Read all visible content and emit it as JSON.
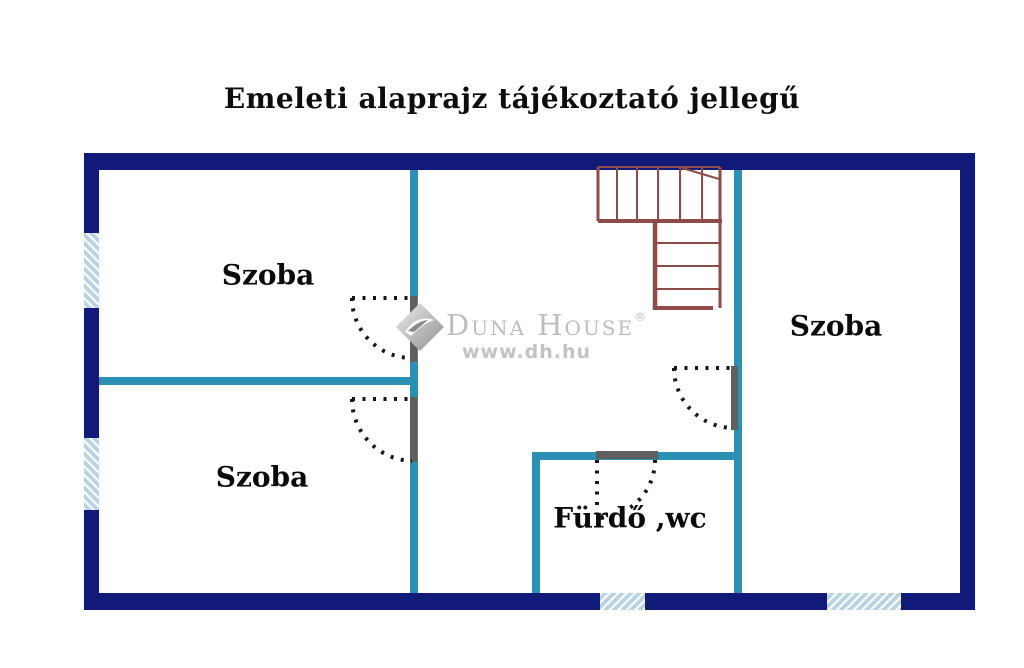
{
  "title": "Emeleti alaprajz tájékoztató jellegű",
  "plan": {
    "rooms": [
      {
        "id": "room-top-left",
        "label": "Szoba"
      },
      {
        "id": "room-bottom-left",
        "label": "Szoba"
      },
      {
        "id": "room-right",
        "label": "Szoba"
      },
      {
        "id": "bathroom",
        "label": "Fürdő ,wc"
      }
    ],
    "features": {
      "windows": 4,
      "doors": 4,
      "staircases": 1
    }
  },
  "watermark": {
    "brand": "Duna House",
    "registered": "®",
    "url": "www.dh.hu"
  },
  "colors": {
    "outer_wall": "#111a78",
    "inner_wall": "#2a91b4",
    "window_fill": "#b9d3e6",
    "stairs": "#8f4a4a",
    "door_leaf": "#5f5f5f",
    "door_arc": "#161616",
    "watermark_gray": "#bfbfbf",
    "text": "#0d0d0d",
    "background": "#ffffff"
  }
}
